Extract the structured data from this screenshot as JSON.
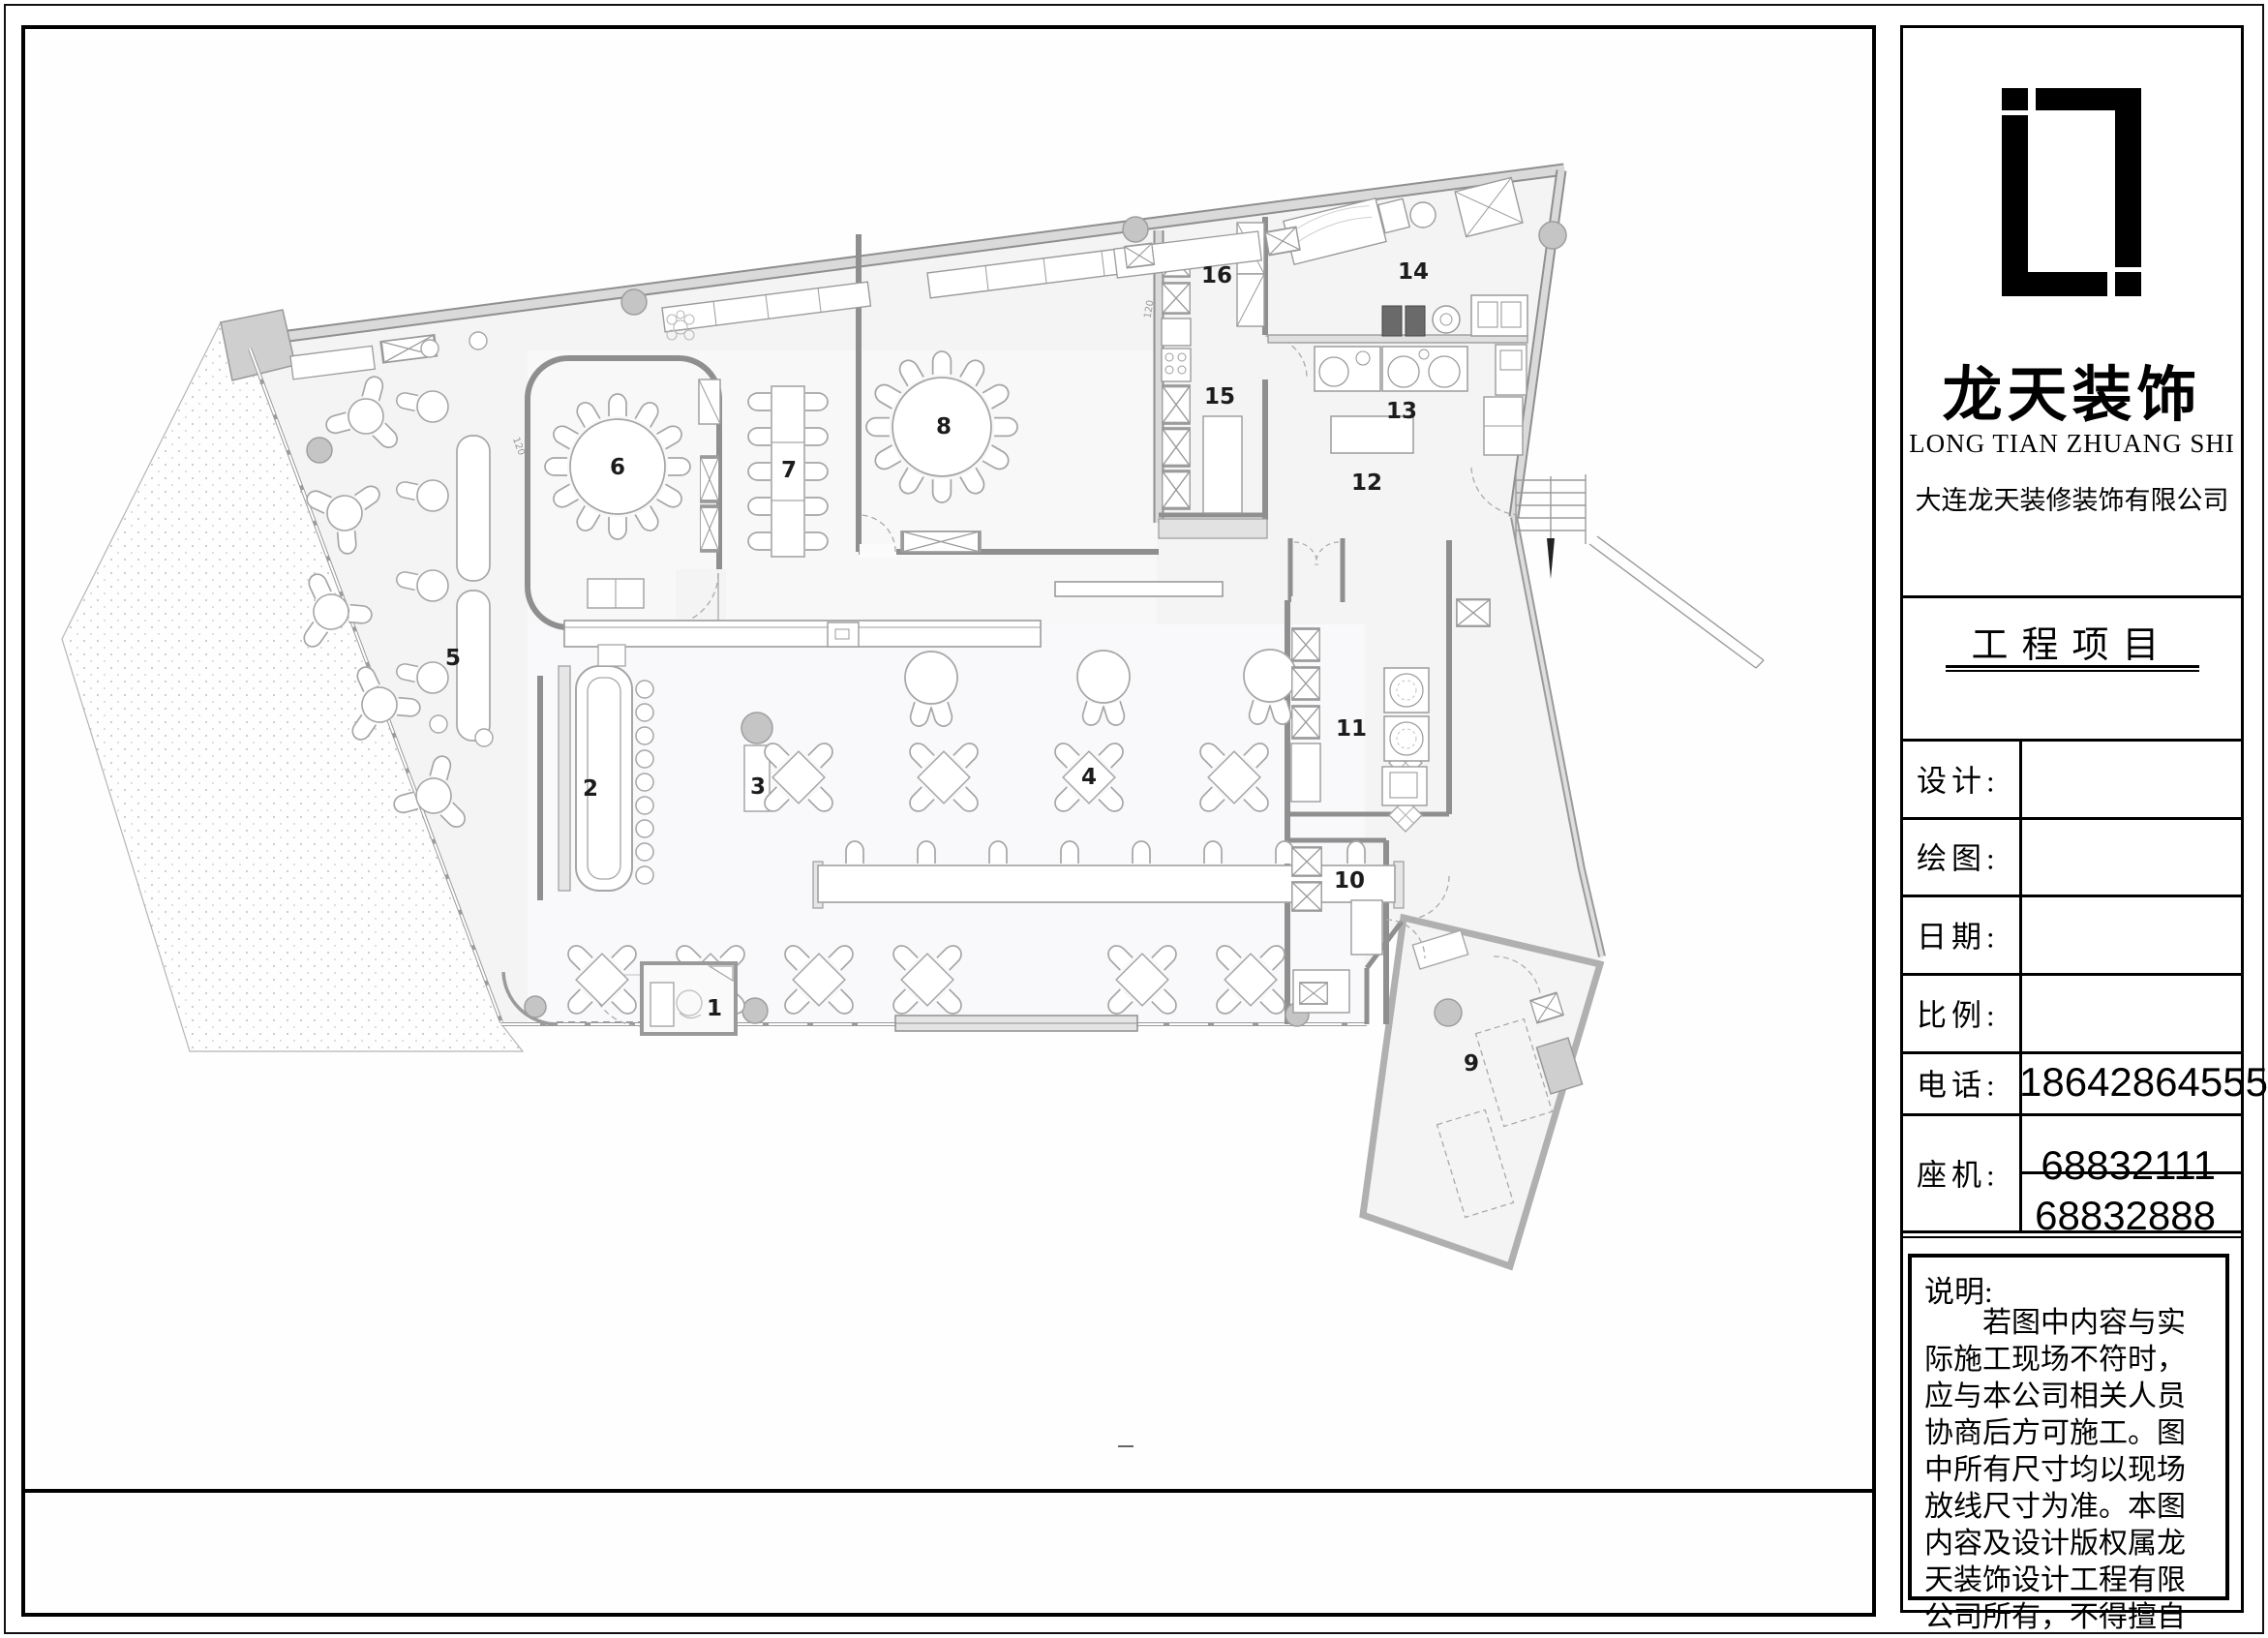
{
  "panel": {
    "logo_cn": "龙天装饰",
    "logo_en": "LONG TIAN ZHUANG SHI",
    "company": "大连龙天装修装饰有限公司",
    "project_title": "工程项目",
    "rows": [
      {
        "label": "设计:",
        "value": ""
      },
      {
        "label": "绘图:",
        "value": ""
      },
      {
        "label": "日期:",
        "value": ""
      },
      {
        "label": "比例:",
        "value": ""
      },
      {
        "label": "电话:",
        "value": "18642864555"
      },
      {
        "label": "座机:",
        "value": "68832111",
        "value2": "68832888"
      }
    ],
    "notes": {
      "title": "说明:",
      "body": "若图中内容与实际施工现场不符时，应与本公司相关人员协商后方可施工。图中所有尺寸均以现场放线尺寸为准。本图内容及设计版权属龙天装饰设计工程有限公司所有，不得擅自抄袭或复印。"
    }
  },
  "plan": {
    "room_labels": [
      "1",
      "2",
      "3",
      "4",
      "5",
      "6",
      "7",
      "8",
      "9",
      "10",
      "11",
      "12",
      "13",
      "14",
      "15",
      "16"
    ],
    "dim_labels": [
      "120",
      "120"
    ]
  },
  "colors": {
    "wall": "#8f8f8f",
    "wall_fill": "#dadada",
    "furniture_line": "#a6a6a6",
    "floor": "#f4f4f5",
    "column_fill": "#c5c5c5",
    "ink": "#000000"
  }
}
